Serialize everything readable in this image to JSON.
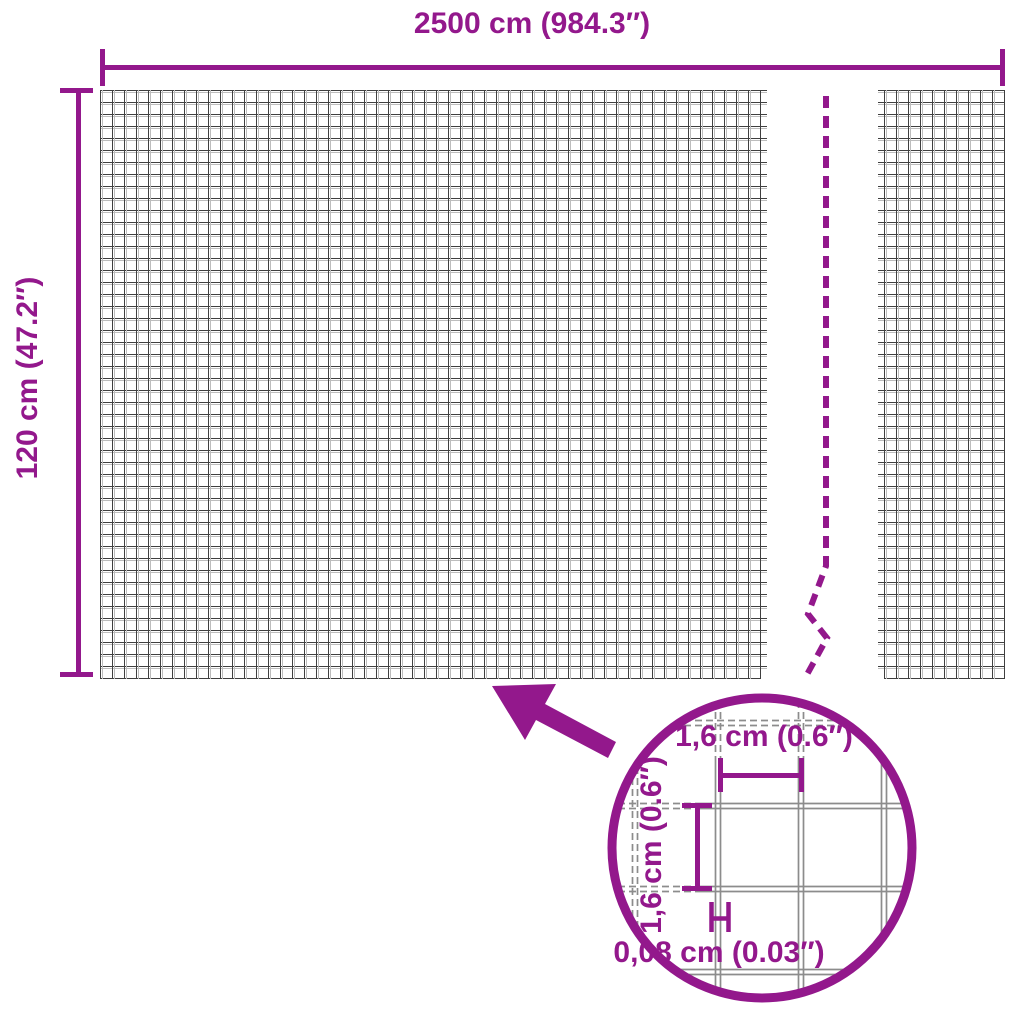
{
  "colors": {
    "accent": "#93188C",
    "mesh_dark": "#3f3f3f",
    "mesh_light": "#bdbdbd",
    "wire_gray": "#8c8c8c",
    "bg": "#ffffff"
  },
  "outer_dimensions": {
    "width_label": "2500 cm (984.3″)",
    "height_label": "120 cm (47.2″)"
  },
  "magnifier": {
    "cell_width_label": "1,6 cm (0.6″)",
    "cell_height_label": "1,6 cm (0.6″)",
    "wire_thickness_label": "0,08 cm (0.03″)"
  }
}
